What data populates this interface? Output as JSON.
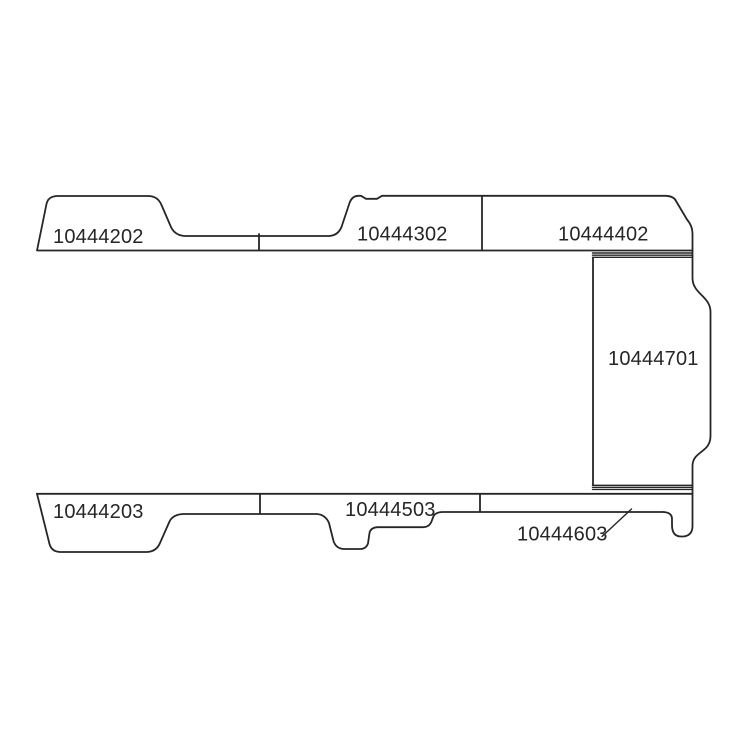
{
  "page": {
    "background": "#ffffff",
    "description_label": ""
  },
  "colors": {
    "line": "#262626",
    "text": "#262626"
  },
  "parts": {
    "top_left": {
      "label": "10444202"
    },
    "top_middle": {
      "label": "10444302"
    },
    "top_right": {
      "label": "10444402"
    },
    "right_side": {
      "label": "10444701"
    },
    "bottom_left": {
      "label": "10444203"
    },
    "bottom_middle": {
      "label": "10444503"
    },
    "bottom_right": {
      "label": "10444603"
    }
  }
}
